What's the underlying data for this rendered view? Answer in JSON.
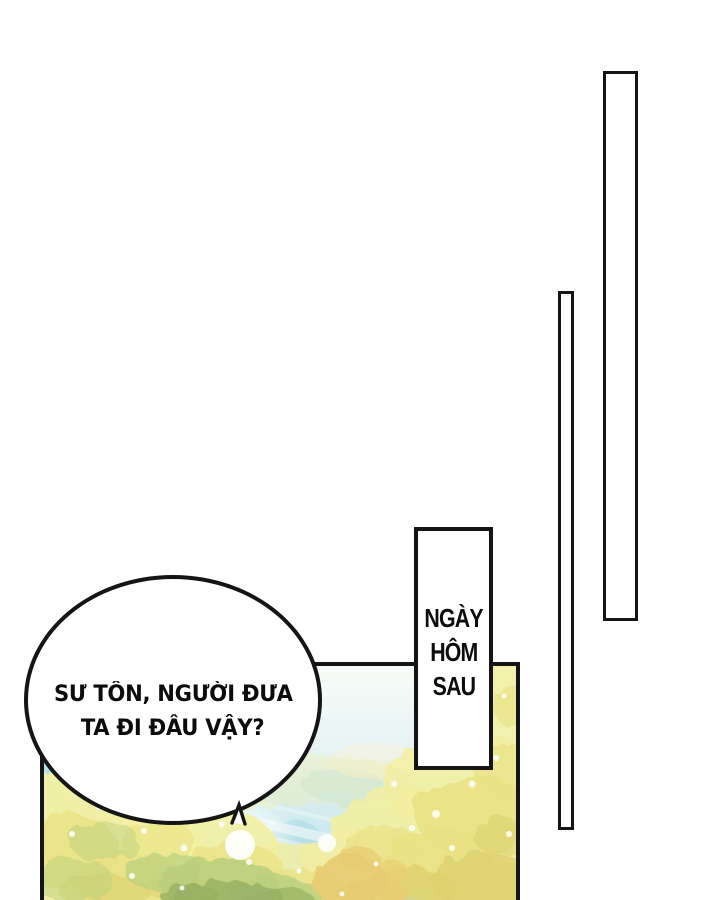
{
  "page": {
    "background": "#ffffff",
    "ink": "#151515"
  },
  "caption_box": {
    "lines": [
      "NGÀY",
      "HÔM",
      "SAU"
    ]
  },
  "speech_bubble": {
    "lines": [
      "SƯ TÔN, NGƯỜI ĐƯA",
      "TA ĐI ĐÂU VẬY?"
    ]
  },
  "artwork": {
    "colors": {
      "sky_top": "#f8fcf8",
      "sky_mid": "#e3f2f2",
      "sky_low": "#cdeaf0",
      "sky_bottom": "#bce3ee",
      "sky_deep": "#a9d8e4",
      "foliage_light": "#f2efa2",
      "foliage_mid": "#e9e184",
      "foliage_deep": "#ddd06e",
      "foliage_green": "#b9cf7d",
      "foliage_olive": "#97b264",
      "foliage_gold": "#e7cb72",
      "glow": "#ffffff",
      "warm_haze": "#f6f2dc"
    }
  }
}
